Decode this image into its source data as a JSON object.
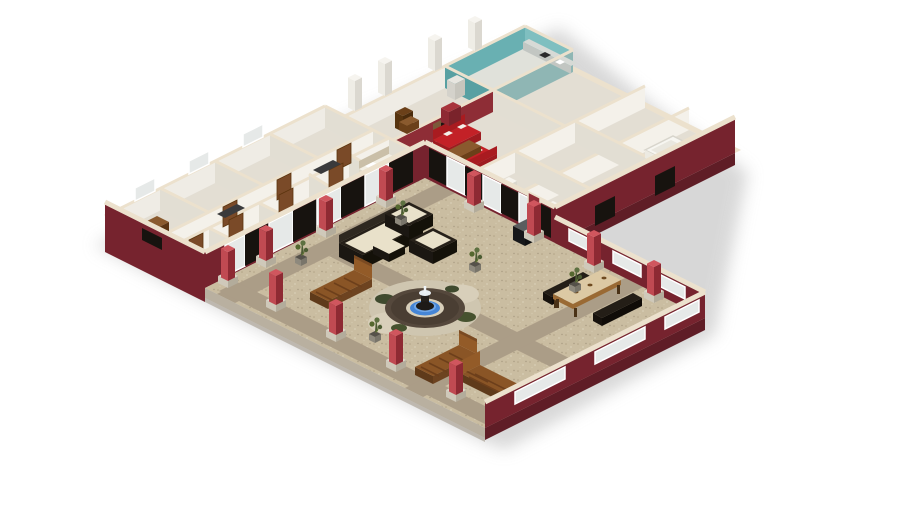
{
  "scene": {
    "type": "3d-architectural-render",
    "description": "Isometric dollhouse cutaway rendering of a single-story house wrapped around a large central courtyard, on a plain white background with a soft ground shadow",
    "background": "#ffffff",
    "no_visible_text": true
  },
  "palette": {
    "exterior_wall_maroon": "#76232e",
    "exterior_wall_lower": "#5f1d26",
    "wall_cap_cream": "#ece1cd",
    "interior_wall_white": "#f4f1ea",
    "interior_wall_shade": "#e2ded3",
    "interior_floor": "#e3ded3",
    "hallway_carpet": "#cfc5b2",
    "courtyard_floor": "#cabda1",
    "courtyard_path": "#ab9d87",
    "pillar_red_light": "#c04a52",
    "pillar_red_dark": "#8e2a33",
    "accent_wall_red": "#8e2d36",
    "sofa_red": "#c32127",
    "kitchen_teal": "#69b0b2",
    "fountain_water_blue": "#4585d6",
    "fountain_basin_brown": "#55483c",
    "wood_furniture": "#8a5a2e",
    "lounge_wood": "#8a5526",
    "wicker_dark": "#262019",
    "cushion_cream": "#e9e1ca",
    "door_brown": "#7a4a28",
    "glass": "#e6e9e8",
    "shadow_grey": "#c9c9c9",
    "chimney_white": "#efede6"
  },
  "house": {
    "wings": [
      {
        "name": "left-wing",
        "rooms": [
          "bedroom",
          "bedroom",
          "bedroom",
          "bathroom",
          "closet",
          "hallway",
          "master-bedroom"
        ]
      },
      {
        "name": "center-block",
        "rooms": [
          "entry-hall",
          "living-room",
          "kitchen"
        ]
      },
      {
        "name": "right-wing",
        "rooms": [
          "bathroom",
          "walk-in-closet",
          "laundry"
        ]
      }
    ],
    "chimney_count": 4,
    "features": [
      "cream wall caps",
      "maroon exterior walls",
      "sliding glass doors to courtyard",
      "white window frames",
      "brown interior doors"
    ]
  },
  "courtyard": {
    "floor": "speckled tan paving",
    "paths": "grey-brown stone walkways in a cross layout",
    "pillar_count": 12,
    "features": [
      "central round fountain with blue water",
      "stone fountain surround with shrubs",
      "red columns on stone bases",
      "low maroon walls with picture windows"
    ],
    "furniture": [
      {
        "item": "wicker-patio-set",
        "pieces": [
          "sofa",
          "armchair",
          "armchair",
          "ottoman"
        ],
        "color": "dark wicker with cream cushions"
      },
      {
        "item": "wooden-chaise-lounge",
        "count": 3
      },
      {
        "item": "outdoor-dining-table",
        "benches": 2,
        "material": "wood"
      },
      {
        "item": "bbq-grill",
        "color": "black"
      },
      {
        "item": "potted-plant",
        "count": 5
      }
    ]
  },
  "interior_furniture": [
    {
      "item": "red-sofa",
      "count": 2,
      "room": "living-room"
    },
    {
      "item": "coffee-table",
      "room": "living-room"
    },
    {
      "item": "fireplace",
      "room": "living-room",
      "wall": "red accent"
    },
    {
      "item": "bookshelf",
      "room": "living-room"
    },
    {
      "item": "red-armchair",
      "room": "living-room"
    },
    {
      "item": "red-wardrobe",
      "room": "entry-hall"
    },
    {
      "item": "kitchen-cabinets",
      "color": "teal",
      "room": "kitchen"
    },
    {
      "item": "bed",
      "room": "master-bedroom"
    },
    {
      "item": "dresser",
      "count": 2
    },
    {
      "item": "bathtub",
      "room": "right-wing-bathroom"
    }
  ]
}
